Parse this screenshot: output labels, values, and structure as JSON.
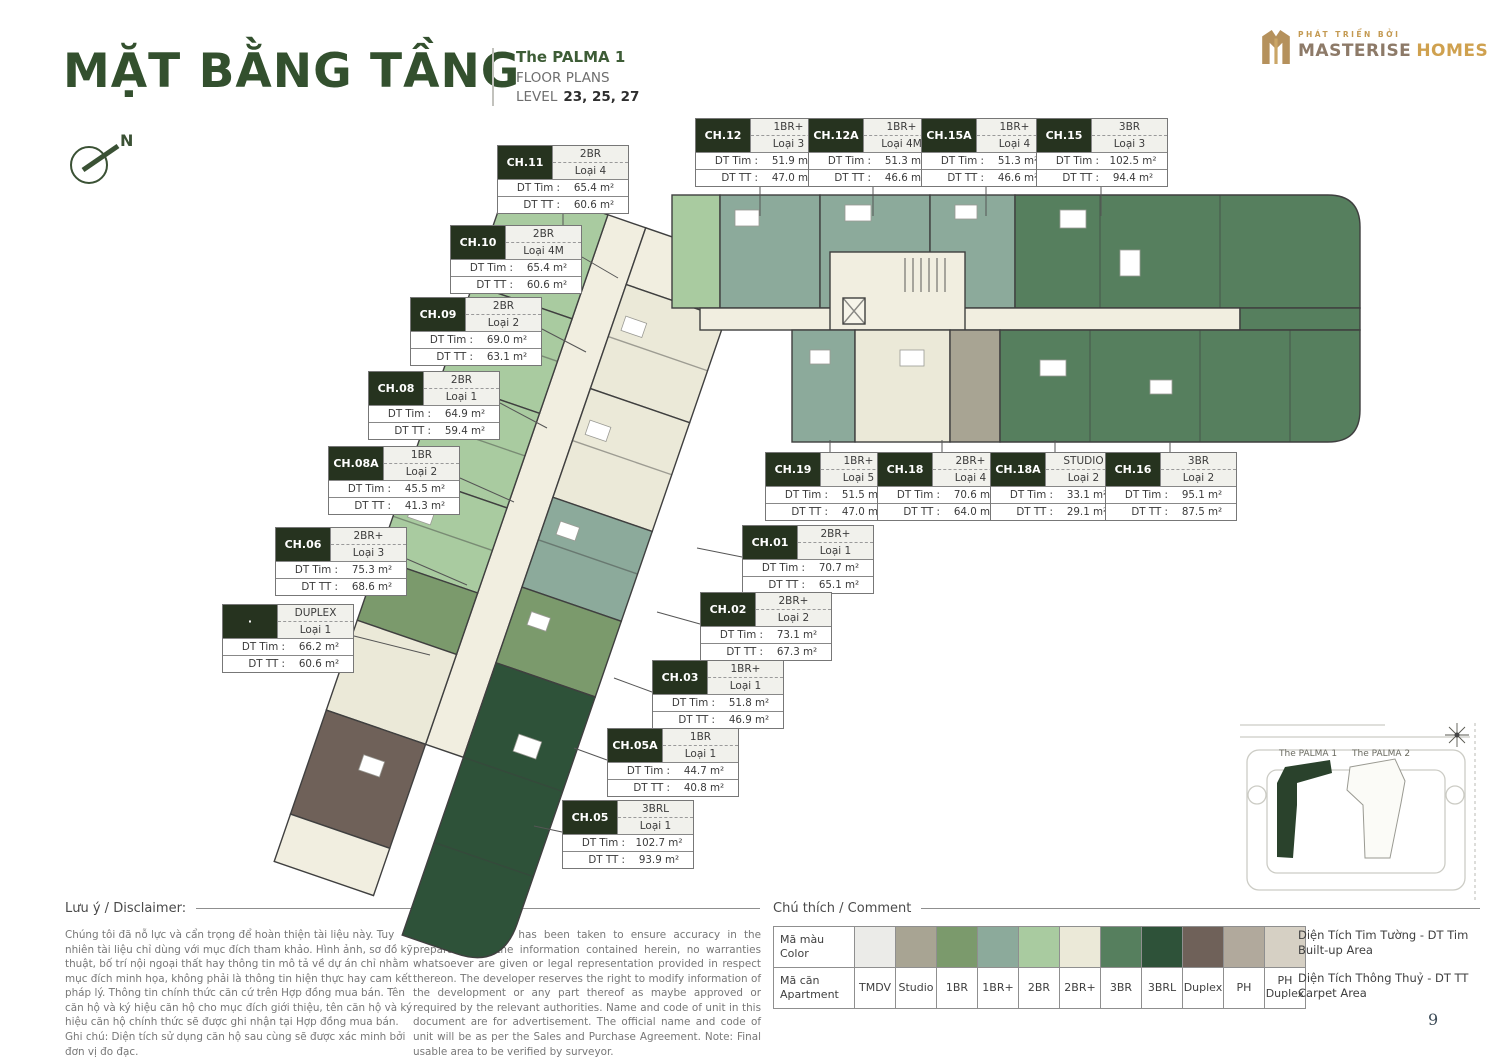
{
  "header": {
    "title": "MẶT BẰNG TẦNG",
    "project": "The PALMA 1",
    "subtitle": "FLOOR PLANS",
    "level_label": "LEVEL",
    "levels": "23, 25, 27",
    "north": "N"
  },
  "logo": {
    "tagline": "PHÁT TRIỂN BỞI",
    "brand_primary": "MASTERISE",
    "brand_secondary": "HOMES"
  },
  "labels": {
    "dt_tim": "DT Tim :",
    "dt_tt": "DT TT :"
  },
  "units": [
    {
      "id": "CH.11",
      "type": "2BR",
      "loai": "Loại 4",
      "dt_tim": "65.4 m²",
      "dt_tt": "60.6 m²"
    },
    {
      "id": "CH.12",
      "type": "1BR+",
      "loai": "Loại 3",
      "dt_tim": "51.9 m²",
      "dt_tt": "47.0 m²"
    },
    {
      "id": "CH.12A",
      "type": "1BR+",
      "loai": "Loại 4M",
      "dt_tim": "51.3 m²",
      "dt_tt": "46.6 m²"
    },
    {
      "id": "CH.15A",
      "type": "1BR+",
      "loai": "Loại 4",
      "dt_tim": "51.3 m²",
      "dt_tt": "46.6 m²"
    },
    {
      "id": "CH.15",
      "type": "3BR",
      "loai": "Loại 3",
      "dt_tim": "102.5 m²",
      "dt_tt": "94.4 m²"
    },
    {
      "id": "CH.10",
      "type": "2BR",
      "loai": "Loại 4M",
      "dt_tim": "65.4 m²",
      "dt_tt": "60.6 m²"
    },
    {
      "id": "CH.09",
      "type": "2BR",
      "loai": "Loại 2",
      "dt_tim": "69.0 m²",
      "dt_tt": "63.1 m²"
    },
    {
      "id": "CH.08",
      "type": "2BR",
      "loai": "Loại 1",
      "dt_tim": "64.9 m²",
      "dt_tt": "59.4 m²"
    },
    {
      "id": "CH.08A",
      "type": "1BR",
      "loai": "Loại 2",
      "dt_tim": "45.5 m²",
      "dt_tt": "41.3 m²"
    },
    {
      "id": "CH.06",
      "type": "2BR+",
      "loai": "Loại 3",
      "dt_tim": "75.3 m²",
      "dt_tt": "68.6 m²"
    },
    {
      "id": "·",
      "type": "DUPLEX",
      "loai": "Loại 1",
      "dt_tim": "66.2 m²",
      "dt_tt": "60.6 m²"
    },
    {
      "id": "CH.19",
      "type": "1BR+",
      "loai": "Loại 5",
      "dt_tim": "51.5 m²",
      "dt_tt": "47.0 m²"
    },
    {
      "id": "CH.18",
      "type": "2BR+",
      "loai": "Loại 4",
      "dt_tim": "70.6 m²",
      "dt_tt": "64.0 m²"
    },
    {
      "id": "CH.18A",
      "type": "STUDIO",
      "loai": "Loại 2",
      "dt_tim": "33.1 m²",
      "dt_tt": "29.1 m²"
    },
    {
      "id": "CH.16",
      "type": "3BR",
      "loai": "Loại 2",
      "dt_tim": "95.1 m²",
      "dt_tt": "87.5 m²"
    },
    {
      "id": "CH.01",
      "type": "2BR+",
      "loai": "Loại 1",
      "dt_tim": "70.7 m²",
      "dt_tt": "65.1 m²"
    },
    {
      "id": "CH.02",
      "type": "2BR+",
      "loai": "Loại 2",
      "dt_tim": "73.1 m²",
      "dt_tt": "67.3 m²"
    },
    {
      "id": "CH.03",
      "type": "1BR+",
      "loai": "Loại 1",
      "dt_tim": "51.8 m²",
      "dt_tt": "46.9 m²"
    },
    {
      "id": "CH.05A",
      "type": "1BR",
      "loai": "Loại 1",
      "dt_tim": "44.7 m²",
      "dt_tt": "40.8 m²"
    },
    {
      "id": "CH.05",
      "type": "3BRL",
      "loai": "Loại 1",
      "dt_tim": "102.7 m²",
      "dt_tt": "93.9 m²"
    }
  ],
  "disclaimer": {
    "heading": "Lưu ý / Disclaimer:",
    "vi": "Chúng tôi đã nỗ lực và cẩn trọng để hoàn thiện tài liệu này. Tuy nhiên tài liệu chỉ dùng với mục đích tham khảo. Hình ảnh, sơ đồ kỹ thuật, bố trí nội ngoại thất hay thông tin mô tả về dự án chỉ nhằm mục đích minh họa, không phải là thông tin hiện thực hay cam kết pháp lý. Thông tin chính thức căn cứ trên Hợp đồng mua bán. Tên căn hộ và ký hiệu căn hộ cho mục đích giới thiệu, tên căn hộ và ký hiệu căn hộ chính thức sẽ được ghi nhận tại Hợp đồng mua bán. Ghi chú: Diện tích sử dụng căn hộ sau cùng sẽ được xác minh bởi đơn vị đo đạc.",
    "en": "Whilst every care has been taken to ensure accuracy in the preparation of the information contained herein, no warranties whatsoever are given or legal representation provided in respect thereon. The developer reserves the right to modify information of the development or any part thereof as maybe approved or required by the relevant authorities. Name and code of unit in this document are for advertisement. The official name and code of unit will be as per the Sales and Purchase Agreement. Note: Final usable area to be verified by surveyor."
  },
  "legend": {
    "heading": "Chú thích / Comment",
    "color_label_vi": "Mã màu",
    "color_label_en": "Color",
    "code_label_vi": "Mã căn",
    "code_label_en": "Apartment",
    "items": [
      {
        "code": "TMDV",
        "color": "#ebebe8"
      },
      {
        "code": "Studio",
        "color": "#a8a493"
      },
      {
        "code": "1BR",
        "color": "#7b9a6c"
      },
      {
        "code": "1BR+",
        "color": "#8caa9b"
      },
      {
        "code": "2BR",
        "color": "#a9cba0"
      },
      {
        "code": "2BR+",
        "color": "#ebe9d8"
      },
      {
        "code": "3BR",
        "color": "#567f5e"
      },
      {
        "code": "3BRL",
        "color": "#2e5239"
      },
      {
        "code": "Duplex",
        "color": "#6f6159"
      },
      {
        "code": "PH",
        "color": "#b1a99c"
      },
      {
        "code": "PH Duplex",
        "color": "#d6d0c4"
      }
    ],
    "notes": [
      {
        "vi": "Diện Tích Tim Tường - DT Tim",
        "en": "Built-up Area"
      },
      {
        "vi": "Diện Tích Thông Thuỷ - DT TT",
        "en": "Carpet Area"
      }
    ]
  },
  "minimap": {
    "building1": "The PALMA 1",
    "building2": "The PALMA 2"
  },
  "page": {
    "number": "9"
  }
}
